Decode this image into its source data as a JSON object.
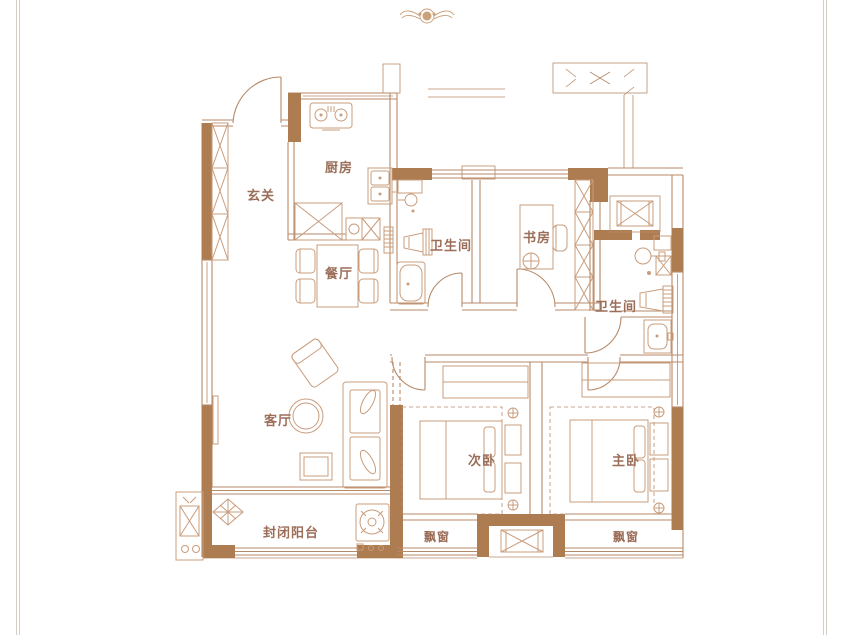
{
  "colors": {
    "background": "#ffffff",
    "wall": "#ae7c51",
    "line": "#b78a68",
    "furniture": "#c99c7c",
    "label": "#9b6e5a",
    "frame": "#d5cec2",
    "ornament": "#c9a17b"
  },
  "emblem": {
    "icon": "winged-ornament-icon"
  },
  "labels": {
    "entry": "玄关",
    "kitchen": "厨房",
    "dining": "餐厅",
    "bathroom1": "卫生间",
    "study": "书房",
    "bathroom2": "卫生间",
    "living": "客厅",
    "balcony": "封闭阳台",
    "second_bedroom": "次卧",
    "master_bedroom": "主卧",
    "bay_window_left": "飘窗",
    "bay_window_right": "飘窗"
  }
}
